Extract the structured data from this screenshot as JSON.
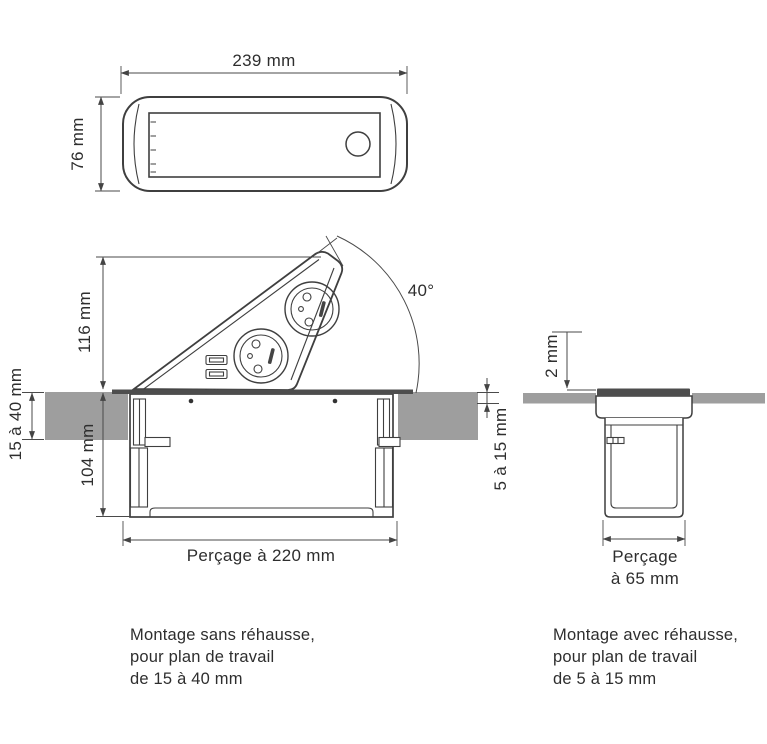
{
  "colors": {
    "line": "#3f3f3f",
    "dimension": "#4a4a4a",
    "worktop_fill": "#9e9e9e",
    "flange_fill": "#4d4d4d",
    "text": "#2e2e2e",
    "background": "#ffffff"
  },
  "top_view": {
    "width_label": "239 mm",
    "height_label": "76 mm"
  },
  "left_section": {
    "height_label": "116 mm",
    "worktop_label": "15 à 40 mm",
    "depth_label": "104 mm",
    "drill_label": "Perçage à 220 mm",
    "angle_label": "40°",
    "usb_label": "5V-2A max"
  },
  "right_section": {
    "riser_label": "2 mm",
    "worktop_label": "5 à 15 mm",
    "drill_label_line1": "Perçage",
    "drill_label_line2": "à 65 mm"
  },
  "captions": {
    "left": {
      "line1": "Montage sans réhausse,",
      "line2": "pour plan de travail",
      "line3": "de 15 à 40 mm"
    },
    "right": {
      "line1": "Montage avec réhausse,",
      "line2": "pour plan de travail",
      "line3": "de 5 à 15 mm"
    }
  }
}
